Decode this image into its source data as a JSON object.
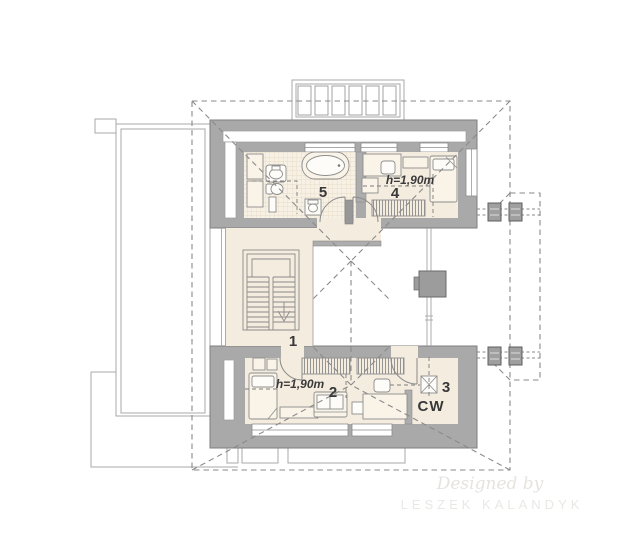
{
  "plan": {
    "rooms": [
      {
        "label": "1"
      },
      {
        "label": "2",
        "height_note": "h=1,90m"
      },
      {
        "label": "3",
        "code": "CW"
      },
      {
        "label": "4",
        "height_note": "h=1,90m"
      },
      {
        "label": "5"
      }
    ],
    "watermark": {
      "prefix": "Designed by",
      "name": "LESZEK KALANDYK"
    },
    "colors": {
      "wall": "#a9a9a9",
      "floor": "#f4ecdf",
      "tile_line": "#e5d7bf",
      "roof_dash": "#8a8a8a",
      "label_text": "#383838",
      "watermark": "#e6e3df"
    }
  }
}
